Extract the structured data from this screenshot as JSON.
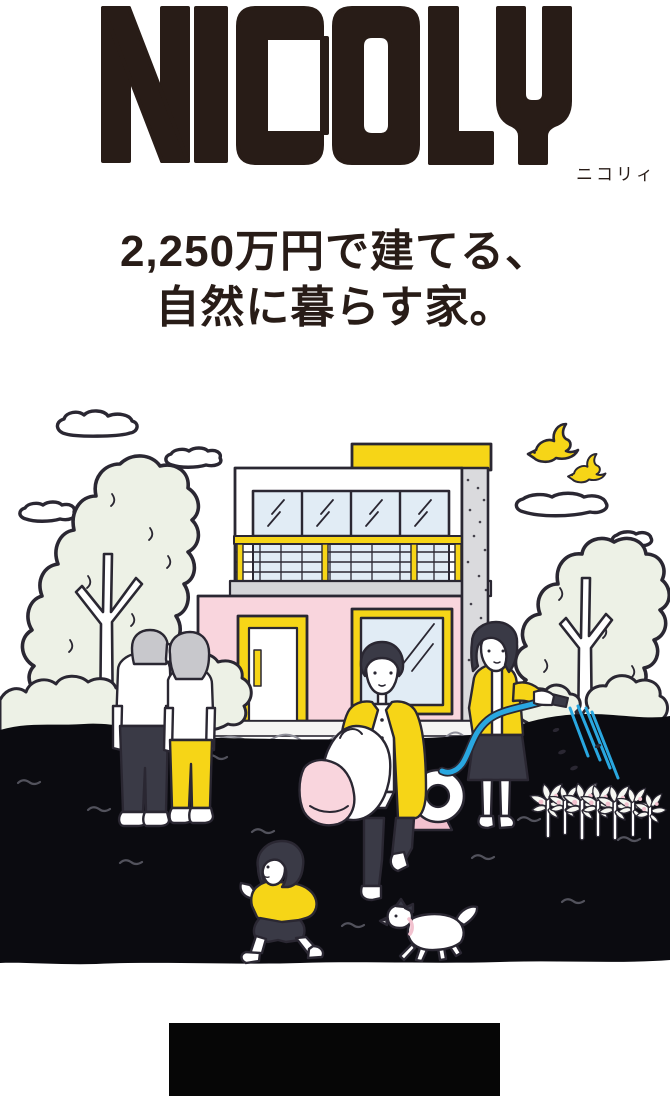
{
  "brand": {
    "logo_text": "NICOLY",
    "logo_ruby": "ニコリィ",
    "tagline_line1": "2,250万円で建てる、",
    "tagline_line2": "自然に暮らす家。"
  },
  "illustration": {
    "alt": "家の前の庭で過ごす三世代家族と犬のイラスト",
    "elements": [
      "clouds",
      "birds",
      "tree-left",
      "tree-right",
      "two-story-house",
      "bushes",
      "grandfather",
      "grandmother",
      "father-with-bags",
      "hose-reel",
      "mother-watering",
      "garden-hose",
      "water-spray",
      "flowers",
      "running-child",
      "running-dog",
      "black-ground"
    ],
    "colors": {
      "ink": "#2a2732",
      "yellow": "#f6d517",
      "pink": "#f9d5dd",
      "pink_deep": "#f2c2cf",
      "glass": "#e1ecf5",
      "hose": "#29a7e0",
      "gray": "#d5d5d8",
      "hair_gray": "#c8c8cc",
      "foliage": "#edf1e6",
      "ground": "#0b0b10",
      "cloth": "#3a3a46",
      "logo": "#281c17",
      "grass": "#52525c"
    }
  },
  "footer": {
    "bar_color": "#060606"
  }
}
